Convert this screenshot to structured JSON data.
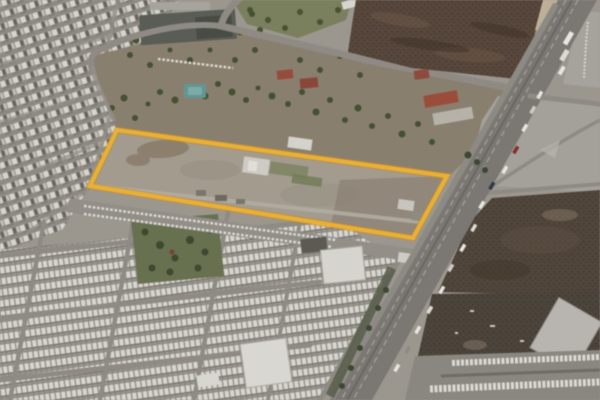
{
  "meta": {
    "view_title": "Satellite aerial view",
    "description": "Compressed aerial satellite frame of an urban area: a long vacant land parcel outlined in yellow, dense low-rise housing and trailer blocks to the west and south, a tree-covered strip and school campus to the north, dark tilled fields to the north-east, and a wide divided highway with traffic running diagonally along the east side toward industrial yards at the bottom right.",
    "visible_text": ""
  },
  "parcel": {
    "label": "highlighted land parcel",
    "points": "117,130 447,176 413,238 90,186",
    "stroke_color": "#eeb02b",
    "under_stroke_color": "#cf8d15"
  },
  "features": {
    "residential_label": "dense residential blocks",
    "trailer_label": "trailer-park housing rows",
    "park_label": "tree-filled park",
    "field_label": "dark tilled field",
    "highway_label": "divided highway with traffic",
    "industrial_label": "industrial yard and trailer rows",
    "campus_label": "campus buildings and trees",
    "pool_label": "teal pool structure"
  },
  "palette": {
    "ground": "#9c978f",
    "highlight_yellow": "#eeb02b",
    "asphalt": "#7b7874",
    "field_brown": "#59463a",
    "vegetation_green": "#43512f",
    "rooftop_white": "#d8d6cf",
    "park_green": "#66714c",
    "pool_teal": "#5e9893"
  }
}
